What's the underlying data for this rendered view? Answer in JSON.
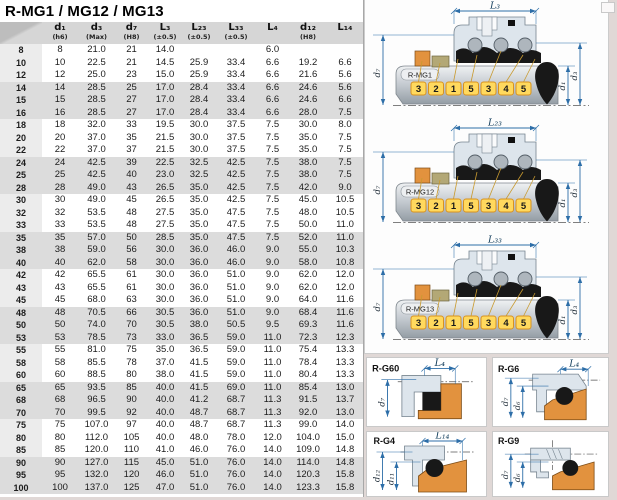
{
  "title": "R-MG1 / MG12 / MG13",
  "table": {
    "columns": [
      {
        "label": "",
        "sub": ""
      },
      {
        "label": "d₁",
        "sub": "(h6)"
      },
      {
        "label": "d₃",
        "sub": "(Max)"
      },
      {
        "label": "d₇",
        "sub": "(H8)"
      },
      {
        "label": "L₃",
        "sub": "(±0.5)"
      },
      {
        "label": "L₂₃",
        "sub": "(±0.5)"
      },
      {
        "label": "L₃₃",
        "sub": "(±0.5)"
      },
      {
        "label": "L₄",
        "sub": ""
      },
      {
        "label": "d₁₂",
        "sub": "(H8)"
      },
      {
        "label": "L₁₄",
        "sub": ""
      }
    ],
    "rows": [
      [
        "8",
        "8",
        "21.0",
        "21",
        "14.0",
        "",
        "",
        "6.0",
        "",
        ""
      ],
      [
        "10",
        "10",
        "22.5",
        "21",
        "14.5",
        "25.9",
        "33.4",
        "6.6",
        "19.2",
        "6.6"
      ],
      [
        "12",
        "12",
        "25.0",
        "23",
        "15.0",
        "25.9",
        "33.4",
        "6.6",
        "21.6",
        "5.6"
      ],
      [
        "14",
        "14",
        "28.5",
        "25",
        "17.0",
        "28.4",
        "33.4",
        "6.6",
        "24.6",
        "5.6"
      ],
      [
        "15",
        "15",
        "28.5",
        "27",
        "17.0",
        "28.4",
        "33.4",
        "6.6",
        "24.6",
        "6.6"
      ],
      [
        "16",
        "16",
        "28.5",
        "27",
        "17.0",
        "28.4",
        "33.4",
        "6.6",
        "28.0",
        "7.5"
      ],
      [
        "18",
        "18",
        "32.0",
        "33",
        "19.5",
        "30.0",
        "37.5",
        "7.5",
        "30.0",
        "8.0"
      ],
      [
        "20",
        "20",
        "37.0",
        "35",
        "21.5",
        "30.0",
        "37.5",
        "7.5",
        "35.0",
        "7.5"
      ],
      [
        "22",
        "22",
        "37.0",
        "37",
        "21.5",
        "30.0",
        "37.5",
        "7.5",
        "35.0",
        "7.5"
      ],
      [
        "24",
        "24",
        "42.5",
        "39",
        "22.5",
        "32.5",
        "42.5",
        "7.5",
        "38.0",
        "7.5"
      ],
      [
        "25",
        "25",
        "42.5",
        "40",
        "23.0",
        "32.5",
        "42.5",
        "7.5",
        "38.0",
        "7.5"
      ],
      [
        "28",
        "28",
        "49.0",
        "43",
        "26.5",
        "35.0",
        "42.5",
        "7.5",
        "42.0",
        "9.0"
      ],
      [
        "30",
        "30",
        "49.0",
        "45",
        "26.5",
        "35.0",
        "42.5",
        "7.5",
        "45.0",
        "10.5"
      ],
      [
        "32",
        "32",
        "53.5",
        "48",
        "27.5",
        "35.0",
        "47.5",
        "7.5",
        "48.0",
        "10.5"
      ],
      [
        "33",
        "33",
        "53.5",
        "48",
        "27.5",
        "35.0",
        "47.5",
        "7.5",
        "50.0",
        "11.0"
      ],
      [
        "35",
        "35",
        "57.0",
        "50",
        "28.5",
        "35.0",
        "47.5",
        "7.5",
        "52.0",
        "11.0"
      ],
      [
        "38",
        "38",
        "59.0",
        "56",
        "30.0",
        "36.0",
        "46.0",
        "9.0",
        "55.0",
        "10.3"
      ],
      [
        "40",
        "40",
        "62.0",
        "58",
        "30.0",
        "36.0",
        "46.0",
        "9.0",
        "58.0",
        "10.8"
      ],
      [
        "42",
        "42",
        "65.5",
        "61",
        "30.0",
        "36.0",
        "51.0",
        "9.0",
        "62.0",
        "12.0"
      ],
      [
        "43",
        "43",
        "65.5",
        "61",
        "30.0",
        "36.0",
        "51.0",
        "9.0",
        "62.0",
        "12.0"
      ],
      [
        "45",
        "45",
        "68.0",
        "63",
        "30.0",
        "36.0",
        "51.0",
        "9.0",
        "64.0",
        "11.6"
      ],
      [
        "48",
        "48",
        "70.5",
        "66",
        "30.5",
        "36.0",
        "51.0",
        "9.0",
        "68.4",
        "11.6"
      ],
      [
        "50",
        "50",
        "74.0",
        "70",
        "30.5",
        "38.0",
        "50.5",
        "9.5",
        "69.3",
        "11.6"
      ],
      [
        "53",
        "53",
        "78.5",
        "73",
        "33.0",
        "36.5",
        "59.0",
        "11.0",
        "72.3",
        "12.3"
      ],
      [
        "55",
        "55",
        "81.0",
        "75",
        "35.0",
        "36.5",
        "59.0",
        "11.0",
        "75.4",
        "13.3"
      ],
      [
        "58",
        "58",
        "85.5",
        "78",
        "37.0",
        "41.5",
        "59.0",
        "11.0",
        "78.4",
        "13.3"
      ],
      [
        "60",
        "60",
        "88.5",
        "80",
        "38.0",
        "41.5",
        "59.0",
        "11.0",
        "80.4",
        "13.3"
      ],
      [
        "65",
        "65",
        "93.5",
        "85",
        "40.0",
        "41.5",
        "69.0",
        "11.0",
        "85.4",
        "13.0"
      ],
      [
        "68",
        "68",
        "96.5",
        "90",
        "40.0",
        "41.2",
        "68.7",
        "11.3",
        "91.5",
        "13.7"
      ],
      [
        "70",
        "70",
        "99.5",
        "92",
        "40.0",
        "48.7",
        "68.7",
        "11.3",
        "92.0",
        "13.0"
      ],
      [
        "75",
        "75",
        "107.0",
        "97",
        "40.0",
        "48.7",
        "68.7",
        "11.3",
        "99.0",
        "14.0"
      ],
      [
        "80",
        "80",
        "112.0",
        "105",
        "40.0",
        "48.0",
        "78.0",
        "12.0",
        "104.0",
        "15.0"
      ],
      [
        "85",
        "85",
        "120.0",
        "110",
        "41.0",
        "46.0",
        "76.0",
        "14.0",
        "109.0",
        "14.8"
      ],
      [
        "90",
        "90",
        "127.0",
        "115",
        "45.0",
        "51.0",
        "76.0",
        "14.0",
        "114.0",
        "14.8"
      ],
      [
        "95",
        "95",
        "132.0",
        "120",
        "46.0",
        "51.0",
        "76.0",
        "14.0",
        "120.3",
        "15.8"
      ],
      [
        "100",
        "100",
        "137.0",
        "125",
        "47.0",
        "51.0",
        "76.0",
        "14.0",
        "123.3",
        "15.8"
      ]
    ]
  },
  "diagrams": {
    "mg": [
      {
        "name": "R-MG1",
        "length_dim": "L₃",
        "dim_left": "d₇",
        "dims_right": [
          "d₁",
          "d₃"
        ],
        "callouts": [
          "3",
          "2",
          "1",
          "5",
          "3",
          "4",
          "5"
        ]
      },
      {
        "name": "R-MG12",
        "length_dim": "L₂₃",
        "dim_left": "d₇",
        "dims_right": [
          "d₁",
          "d₃"
        ],
        "callouts": [
          "3",
          "2",
          "1",
          "5",
          "3",
          "4",
          "5"
        ]
      },
      {
        "name": "R-MG13",
        "length_dim": "L₃₃",
        "dim_left": "d₇",
        "dims_right": [
          "d₁",
          "d₃"
        ],
        "callouts": [
          "3",
          "2",
          "1",
          "5",
          "3",
          "4",
          "5"
        ]
      }
    ],
    "g": [
      {
        "name": "R-G60",
        "top_dim": "L₄",
        "left_dims": [
          "d₇"
        ]
      },
      {
        "name": "R-G6",
        "top_dim": "L₄",
        "left_dims": [
          "d₇",
          "d₆"
        ]
      },
      {
        "name": "R-G4",
        "top_dim": "L₁₄",
        "left_dims": [
          "d₁₂",
          "d₁₁"
        ]
      },
      {
        "name": "R-G9",
        "top_dim": "",
        "left_dims": [
          "d₇",
          "d₆"
        ]
      }
    ]
  },
  "colors": {
    "dimension_blue": "#2d6ea8",
    "dim_label": "#16405e",
    "callout_yellow": "#ffd95e",
    "callout_border": "#d8921e",
    "orange_part": "#e2923e",
    "olive_part": "#b3a876",
    "metal_light": "#dde5ec",
    "metal_stroke": "#76848f",
    "rubber_black": "#181818",
    "band_gray": "#dcdcdc",
    "page_background": "#e0d8d6"
  }
}
